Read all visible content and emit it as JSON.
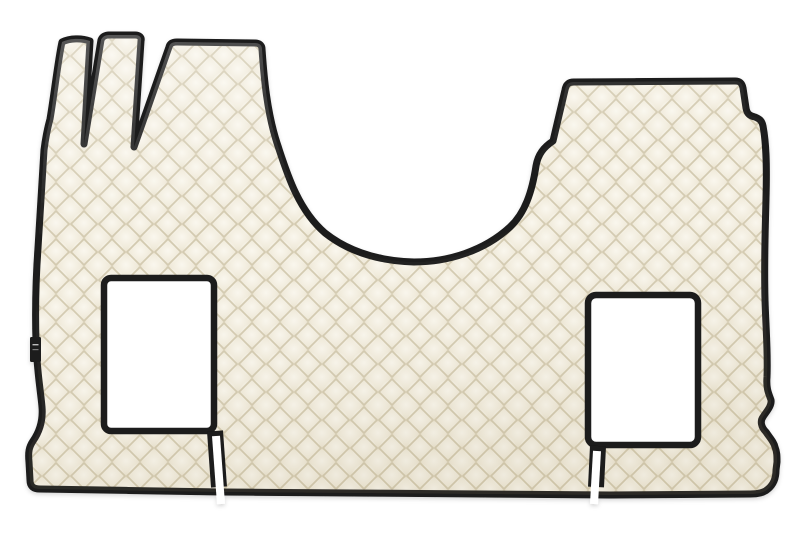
{
  "scene": {
    "description": "Product photo on a plain white background: a cream / ivory quilted eco-leather truck cab floor mat set with black piping trim, diamond-stitched pattern, two white rectangular seat-base cutouts, three narrow pedal-area tongues at the top left, a wide block at the top right, a curved engine-tunnel recess between them, slits running from each cutout to the bottom edge, and a small black brand tag on the left edge.",
    "background_color": "#ffffff"
  },
  "mat": {
    "base_color": "#ece5d2",
    "diamond_highlight_color": "#faf7ee",
    "seam_color": "#d3cab0",
    "piping_color": "#1a1a1a",
    "quilt_pitch_px": 28,
    "outline_path": "M62,42 C70,38 82,38 90,41 L84,144 L101,40 C102,37 105,35 109,35 L135,35 C139,35 142,37 141,41 L134,147 L169,47 C170,43 173,42 177,42 L255,43 C259,43 262,45 262,49 C264,78 267,112 277,143 C286,170 297,209 325,233 C349,252 380,261 414,262 C448,262 484,251 510,227 C525,213 532,192 536,166 C538,154 544,147 553,141 L565,90 C566,84 569,82 574,82 L735,81 C740,81 742,83 743,88 L746,108 C747,114 750,116 755,117 C760,119 762,121 763,126 C766,142 767,162 766,198 C765,240 764,262 765,300 C766,332 768,352 767,377 C766,389 769,394 771,400 C772,406 766,412 763,417 C760,421 761,427 766,432 C770,438 774,442 775,447 C777,452 777,456 777,462 L776,470 C776,479 773,485 768,489 C764,493 757,494 750,494 L610,495 L222,492 L40,489 C33,489 30,486 30,480 L29,462 C28,452 29,447 33,441 C40,431 43,419 42,407 C41,394 37,372 36,342 C35,308 36,276 38,248 C40,212 42,180 44,150 C45,142 47,130 50,119 C54,96 58,60 62,42 Z",
    "left_cutout": {
      "x": 104,
      "y": 278,
      "width": 110,
      "height": 153,
      "radius": 7,
      "fill": "#ffffff"
    },
    "right_cutout": {
      "x": 588,
      "y": 295,
      "width": 110,
      "height": 150,
      "radius": 8,
      "fill": "#ffffff"
    },
    "left_slit": {
      "casing_path": "M215,431 L219,487",
      "gap_path": "M216,436 L221,504"
    },
    "right_slit": {
      "casing_path": "M598,446 L596,487",
      "gap_path": "M597,451 L594,504"
    },
    "brand_tag": {
      "x": 30,
      "y": 337,
      "width": 11,
      "height": 25,
      "radius": 1.5,
      "color": "#1b1b1b"
    }
  }
}
